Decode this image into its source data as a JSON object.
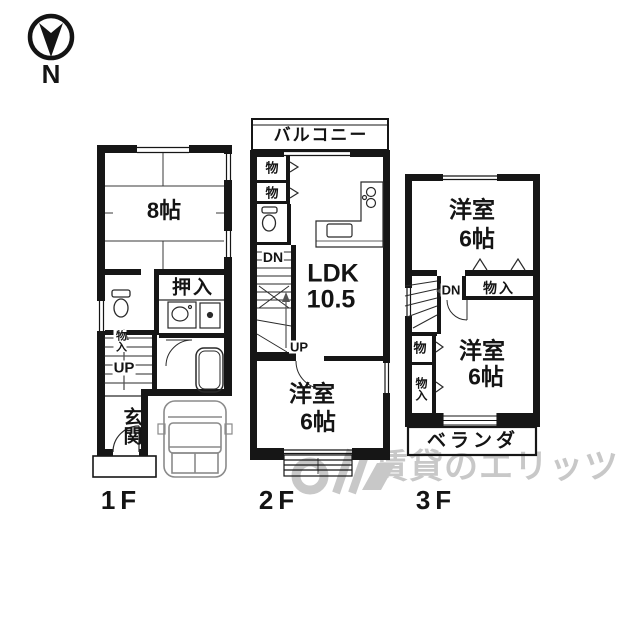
{
  "compass": {
    "north_label": "N"
  },
  "watermark": {
    "text": "賃貸のエリッツ"
  },
  "floor1": {
    "label": "1F",
    "tatami_room": "8帖",
    "closet_oshiire": "押入",
    "closet_monoire": "物入",
    "stairs_up": "UP",
    "entrance": "玄関"
  },
  "floor2": {
    "label": "2F",
    "balcony": "バルコニー",
    "storage_1": "物",
    "storage_2": "物",
    "stairs_dn": "DN",
    "stairs_up": "UP",
    "ldk_name": "LDK",
    "ldk_size": "10.5",
    "western_room_name": "洋室",
    "western_room_size": "6帖"
  },
  "floor3": {
    "label": "3F",
    "western_room1_name": "洋室",
    "western_room1_size": "6帖",
    "stairs_dn": "DN",
    "closet_monoire_upper": "物入",
    "storage": "物",
    "closet_monoire_lower": "物入",
    "western_room2_name": "洋室",
    "western_room2_size": "6帖",
    "veranda": "ベランダ"
  }
}
